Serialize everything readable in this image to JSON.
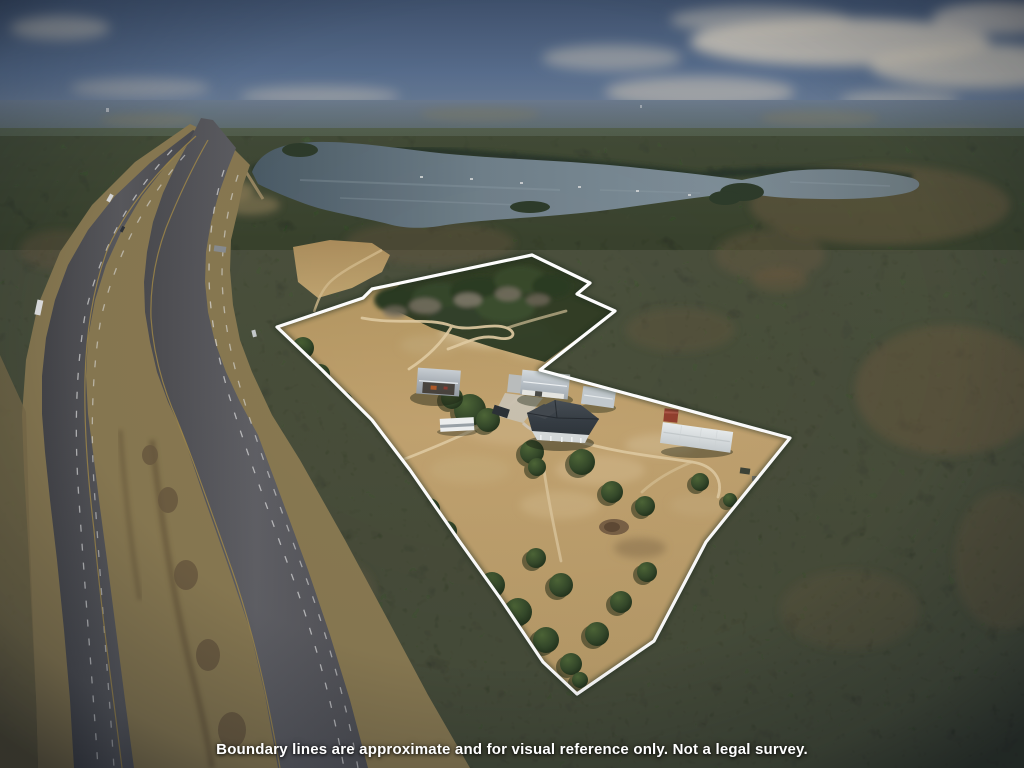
{
  "caption": {
    "text": "Boundary lines are approximate and for visual reference only. Not a legal survey."
  },
  "scene": {
    "type": "aerial-drone-photograph",
    "subject": "Rural acreage property outlined with a white boundary-line overlay",
    "landmarks": {
      "water": "lake",
      "road": "divided highway",
      "vegetation": "pine and hardwood forest",
      "parcel": "cleared homesite with pasture"
    },
    "structures": [
      "main house",
      "pole barn",
      "metal workshop",
      "storage shed",
      "mobile home",
      "red shed",
      "rv camper"
    ]
  },
  "colors": {
    "boundary_line": "#ffffff",
    "caption_text": "#ffffff",
    "sky": "#5a7090",
    "lake_water": "#6e7e88",
    "cleared_land": "#c0a271",
    "forest": "#2c3a25",
    "asphalt": "#54545a"
  }
}
